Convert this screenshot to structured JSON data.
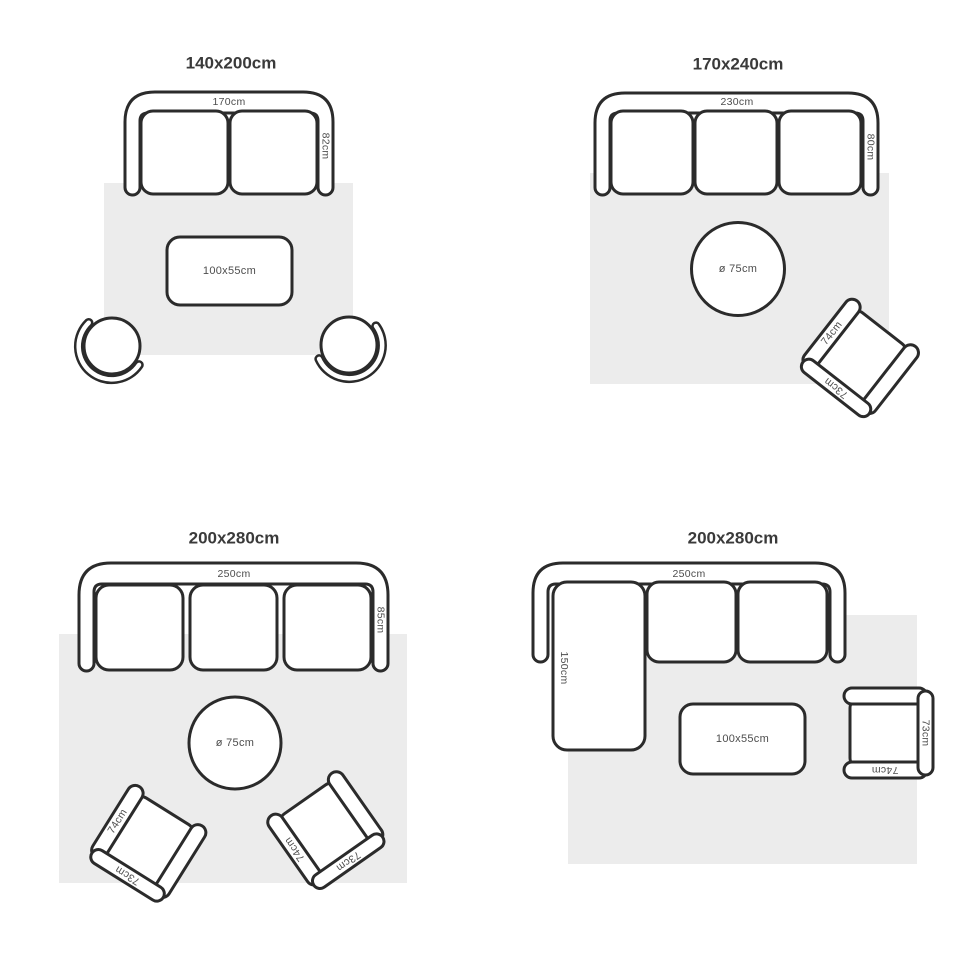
{
  "style": {
    "outline_color": "#2b2b2b",
    "rug_color": "#ececec",
    "label_color": "#4d4d4d",
    "title_color": "#3a3a3a",
    "background": "#ffffff"
  },
  "quadrants": [
    {
      "title": "140x200cm",
      "sofa": {
        "width_label": "170cm",
        "depth_label": "82cm"
      },
      "coffee_table": {
        "size_label": "100x55cm"
      }
    },
    {
      "title": "170x240cm",
      "sofa": {
        "width_label": "230cm",
        "depth_label": "80cm"
      },
      "round_table": {
        "size_label": "ø 75cm"
      },
      "armchair": {
        "arm_label": "74cm",
        "front_label": "73cm"
      }
    },
    {
      "title": "200x280cm",
      "sofa": {
        "width_label": "250cm",
        "depth_label": "85cm"
      },
      "round_table": {
        "size_label": "ø 75cm"
      },
      "armchair_left": {
        "arm_label": "74cm",
        "front_label": "73cm"
      },
      "armchair_right": {
        "arm_label": "74cm",
        "front_label": "73cm"
      }
    },
    {
      "title": "200x280cm",
      "sofa": {
        "width_label": "250cm",
        "chaise_label": "150cm"
      },
      "coffee_table": {
        "size_label": "100x55cm"
      },
      "armchair": {
        "arm_label": "74cm",
        "front_label": "73cm"
      }
    }
  ]
}
